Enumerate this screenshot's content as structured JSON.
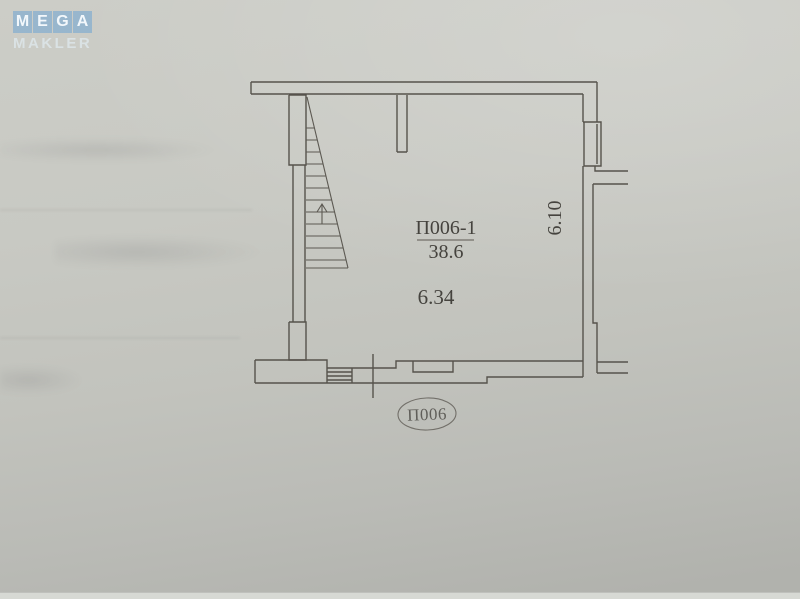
{
  "watermark": {
    "line1": "MEGA",
    "letters": [
      "M",
      "E",
      "G",
      "A"
    ],
    "line2": "MAKLER",
    "tile_color": "#7caad0"
  },
  "plan": {
    "room_label": "П006-1",
    "room_area": "38.6",
    "dim_horizontal": "6.34",
    "dim_vertical": "6.10",
    "stamp_label": "П006",
    "ink_color": "#56534c"
  }
}
